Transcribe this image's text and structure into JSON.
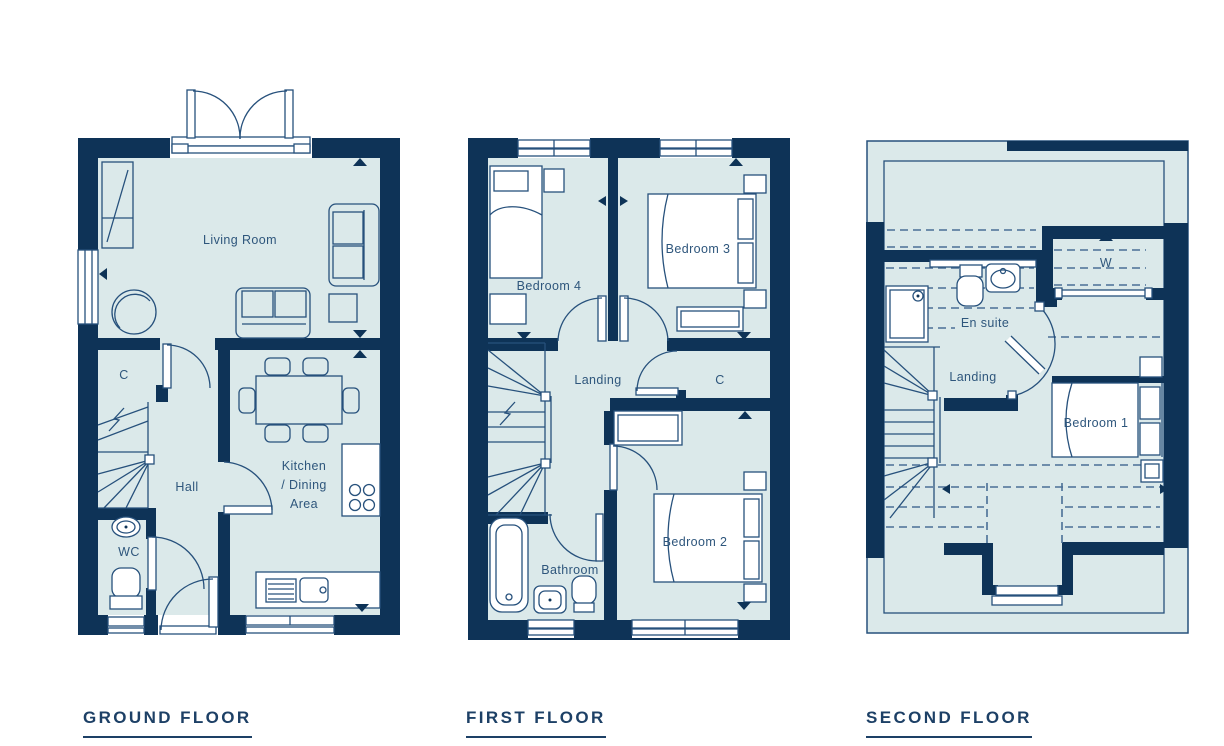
{
  "palette": {
    "wall_navy": "#0E3357",
    "room_fill": "#DBE9EA",
    "line": "#27517C",
    "dash": "#4A6F96",
    "label_text": "#2E567C",
    "title_text": "#1D4066",
    "background": "#FFFFFF"
  },
  "floors": [
    {
      "id": "ground",
      "title": "GROUND FLOOR",
      "labels": {
        "living_room": "Living Room",
        "cupboard": "C",
        "hall": "Hall",
        "wc": "WC",
        "kitchen_l1": "Kitchen",
        "kitchen_l2": "/ Dining",
        "kitchen_l3": "Area"
      }
    },
    {
      "id": "first",
      "title": "FIRST FLOOR",
      "labels": {
        "bedroom4": "Bedroom 4",
        "bedroom3": "Bedroom 3",
        "landing": "Landing",
        "cupboard": "C",
        "bathroom": "Bathroom",
        "bedroom2": "Bedroom 2"
      }
    },
    {
      "id": "second",
      "title": "SECOND FLOOR",
      "labels": {
        "wardrobe": "W",
        "ensuite": "En suite",
        "landing": "Landing",
        "bedroom1": "Bedroom 1"
      }
    }
  ]
}
